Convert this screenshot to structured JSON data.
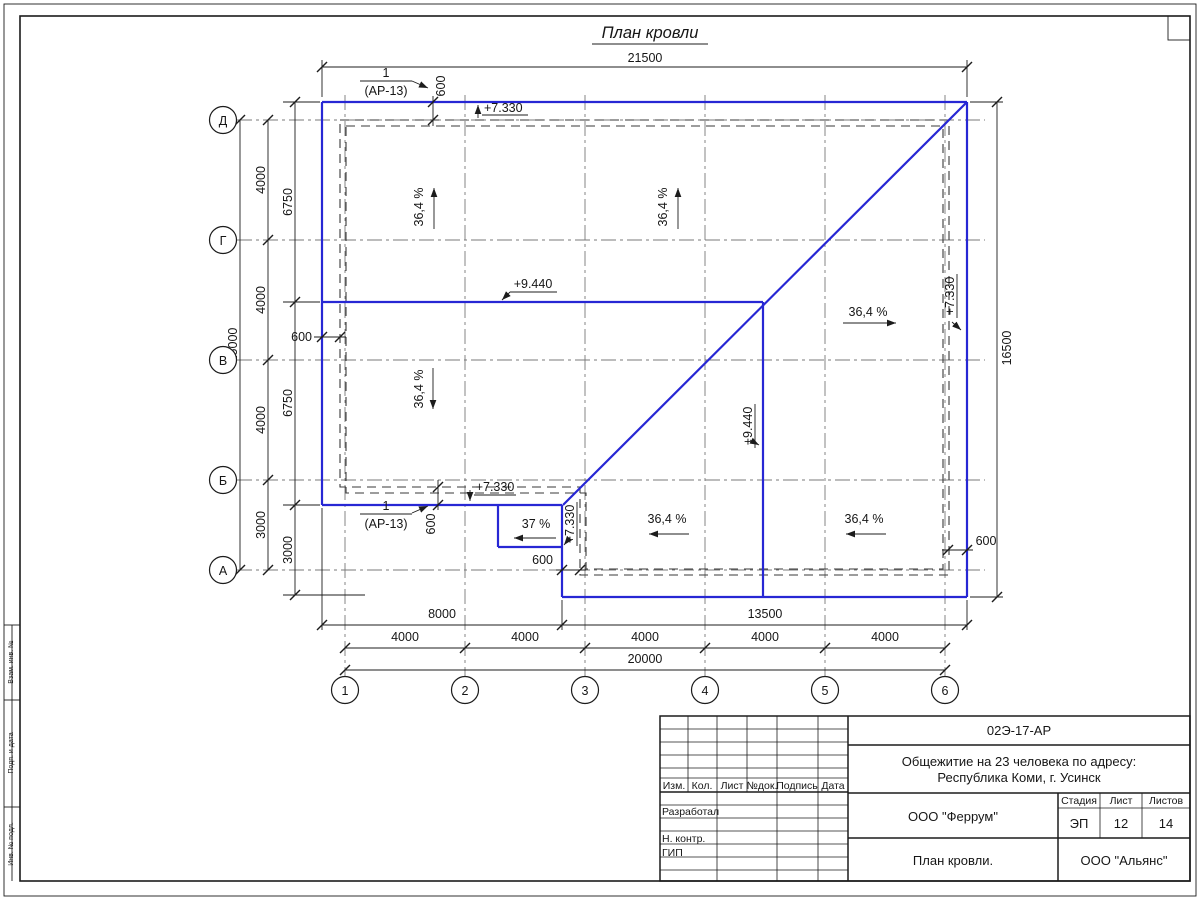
{
  "drawing_title": "План кровли",
  "axes": {
    "rows": [
      "Д",
      "Г",
      "В",
      "Б",
      "А"
    ],
    "cols": [
      "1",
      "2",
      "3",
      "4",
      "5",
      "6"
    ]
  },
  "dims": {
    "top_total": "21500",
    "right_total": "16500",
    "left_total": "15000",
    "left_seg": [
      "4000",
      "4000",
      "4000",
      "3000"
    ],
    "left_inner": [
      "6750",
      "6750",
      "3000"
    ],
    "bottom_seg": [
      "8000",
      "13500"
    ],
    "bottom_axes": [
      "4000",
      "4000",
      "4000",
      "4000",
      "4000"
    ],
    "bottom_total": "20000",
    "off_top": "600",
    "off_left": "600",
    "off_bottom_left": "600",
    "off_bottom_mid": "600",
    "off_bottom_right": "600"
  },
  "marks": {
    "top_eave": "+7.330",
    "ridge": "+9.440",
    "ridge_v": "+9.440",
    "right_eave": "+7.330",
    "bottom_left_eave": "+7.330",
    "canopy": "+7.330"
  },
  "slopes": {
    "nw": "36,4 %",
    "n": "36,4 %",
    "e": "36,4 %",
    "w": "36,4 %",
    "s1": "36,4 %",
    "s2": "36,4 %",
    "canopy": "37 %"
  },
  "callouts": {
    "top": {
      "num": "1",
      "ref": "(АР-13)"
    },
    "bottom": {
      "num": "1",
      "ref": "(АР-13)"
    }
  },
  "titleblock": {
    "doc_code": "02Э-17-АР",
    "object_line1": "Общежитие на 23 человека по адресу:",
    "object_line2": "Республика Коми, г. Усинск",
    "org": "ООО \"Феррум\"",
    "sheet_name": "План кровли.",
    "contractor": "ООО \"Альянс\"",
    "stage_label": "Стадия",
    "sheet_label": "Лист",
    "sheets_label": "Листов",
    "stage": "ЭП",
    "sheet_num": "12",
    "sheets_total": "14",
    "cols": [
      "Изм.",
      "Кол.",
      "Лист",
      "№док.",
      "Подпись",
      "Дата"
    ],
    "roles": [
      "Разработал",
      "Н. контр.",
      "ГИП"
    ]
  },
  "frame_labels": [
    "Взам. инв. №",
    "Подп. и дата",
    "Инв. № подл."
  ],
  "colors": {
    "roof_line": "#2727d4",
    "ink": "#1c1c1c"
  }
}
